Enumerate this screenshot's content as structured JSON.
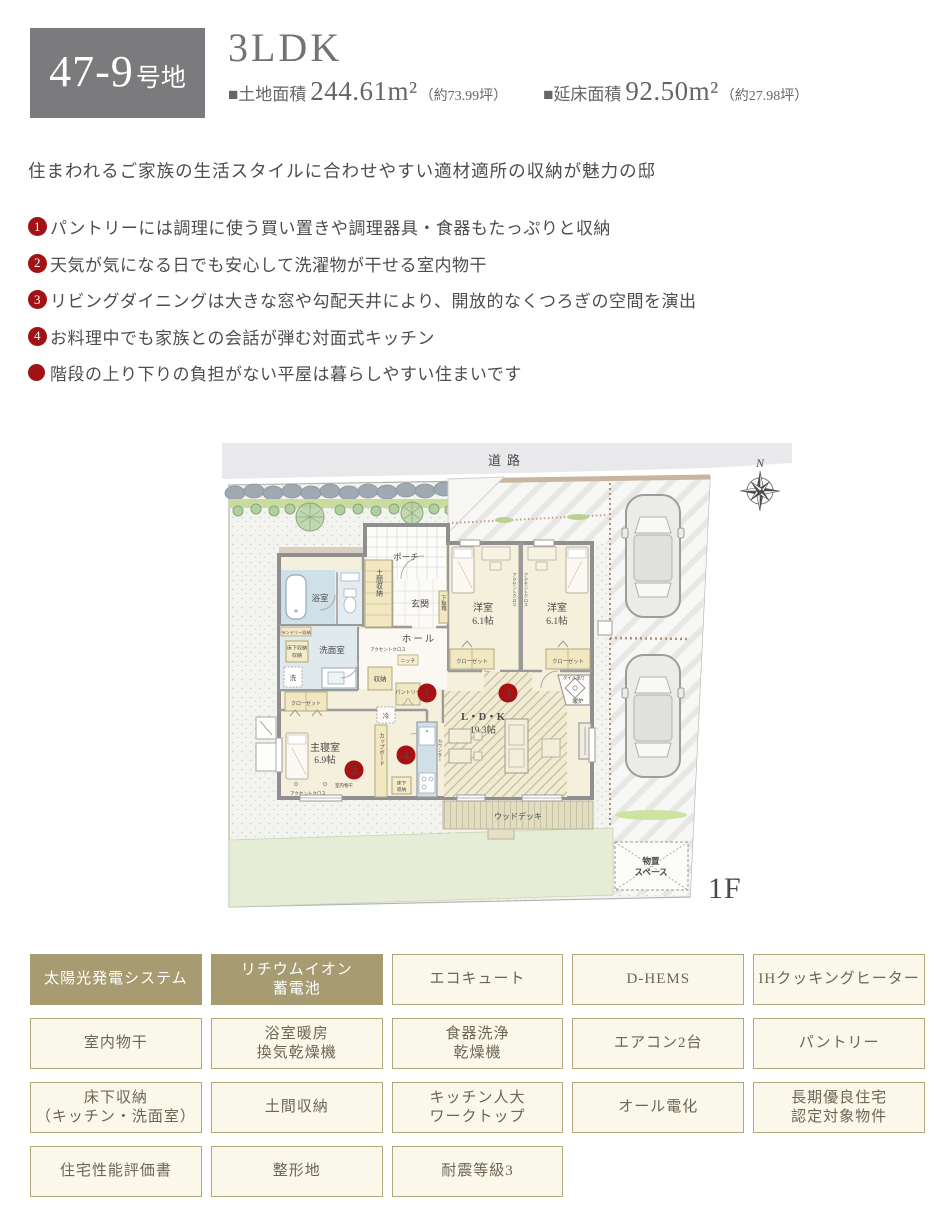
{
  "colors": {
    "accent_red": "#a21113",
    "tag_khaki": "#a79b72",
    "tag_cream": "#faf7eb",
    "header_gray": "#7b7b7e"
  },
  "header": {
    "lot_number": "47-9",
    "lot_suffix": "号地",
    "plan_type": "3LDK",
    "land_label": "■土地面積",
    "land_value": "244.61m²",
    "land_tsubo": "（約73.99坪）",
    "floor_label": "■延床面積",
    "floor_value": "92.50m²",
    "floor_tsubo": "（約27.98坪）"
  },
  "intro": "住まわれるご家族の生活スタイルに合わせやすい適材適所の収納が魅力の邸",
  "features": [
    {
      "num": "1",
      "text": "パントリーには調理に使う買い置きや調理器具・食器もたっぷりと収納"
    },
    {
      "num": "2",
      "text": "天気が気になる日でも安心して洗濯物が干せる室内物干"
    },
    {
      "num": "3",
      "text": "リビングダイニングは大きな窓や勾配天井により、開放的なくつろぎの空間を演出"
    },
    {
      "num": "4",
      "text": "お料理中でも家族との会話が弾む対面式キッチン"
    },
    {
      "num": "",
      "text": "階段の上り下りの負担がない平屋は暮らしやすい住まいです"
    }
  ],
  "plan": {
    "road": "道路",
    "north": "N",
    "floor_tag": "1F",
    "badges": {
      "b1": "1",
      "b2": "2",
      "b3": "3",
      "b4": "4"
    },
    "labels": {
      "porch": "ポーチ",
      "doma": "土間収納",
      "genkan": "玄関",
      "getabako": "下駄箱",
      "hall": "ホール",
      "bath": "浴室",
      "laundry": "ランドリー収納",
      "underfloor": "床下収納",
      "underfloor2": "床下収納",
      "senmen": "洗面室",
      "washer": "洗",
      "closet": "クローゼット",
      "closet2": "クローゼット",
      "closet3": "クローゼット",
      "shuno": "収納",
      "niche": "ニッチ",
      "accent": "アクセントクロス",
      "accent2": "アクセントクロス",
      "accent3": "アクセントクロス",
      "accent4": "アクセントクロス",
      "pantry": "パントリー",
      "fridge": "冷",
      "cupboard": "カップボード",
      "counter": "カウンター",
      "master": "主寝室",
      "master_size": "6.9帖",
      "monohoshi": "室内物干",
      "west": "洋室",
      "west_size": "6.1帖",
      "west2": "洋室",
      "west2_size": "6.1帖",
      "ldk": "L・D・K",
      "ldk_size": "19.3帖",
      "tile": "タイル張り",
      "stove": "暖炉",
      "deck": "ウッドデッキ",
      "shed1": "物置",
      "shed2": "スペース"
    }
  },
  "tags": {
    "items": [
      {
        "label": "太陽光発電システム",
        "filled": true
      },
      {
        "label": "リチウムイオン\n蓄電池",
        "filled": true
      },
      {
        "label": "エコキュート",
        "filled": false
      },
      {
        "label": "D-HEMS",
        "filled": false
      },
      {
        "label": "IHクッキングヒーター",
        "filled": false
      },
      {
        "label": "室内物干",
        "filled": false
      },
      {
        "label": "浴室暖房\n換気乾燥機",
        "filled": false
      },
      {
        "label": "食器洗浄\n乾燥機",
        "filled": false
      },
      {
        "label": "エアコン2台",
        "filled": false
      },
      {
        "label": "パントリー",
        "filled": false
      },
      {
        "label": "床下収納\n（キッチン・洗面室）",
        "filled": false
      },
      {
        "label": "土間収納",
        "filled": false
      },
      {
        "label": "キッチン人大\nワークトップ",
        "filled": false
      },
      {
        "label": "オール電化",
        "filled": false
      },
      {
        "label": "長期優良住宅\n認定対象物件",
        "filled": false
      },
      {
        "label": "住宅性能評価書",
        "filled": false
      },
      {
        "label": "整形地",
        "filled": false
      },
      {
        "label": "耐震等級3",
        "filled": false
      }
    ]
  }
}
